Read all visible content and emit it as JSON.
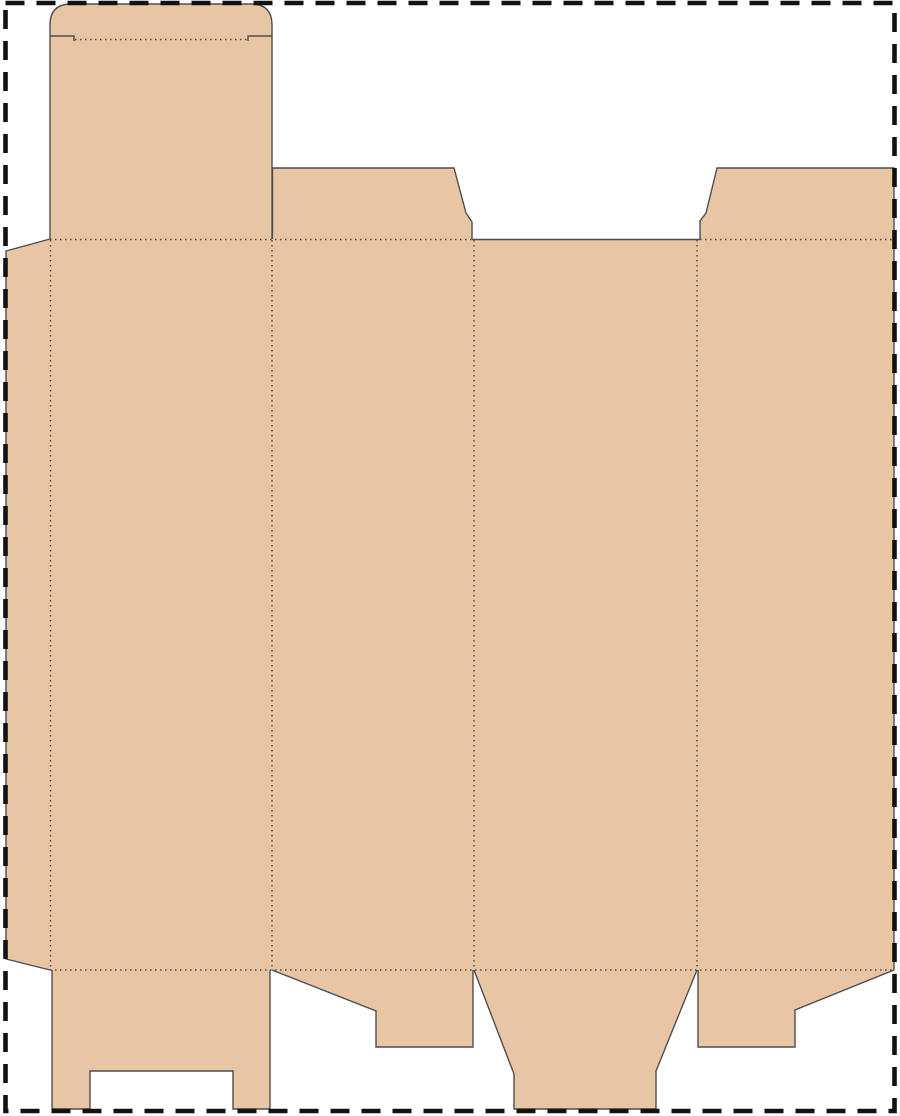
{
  "canvas": {
    "width": 900,
    "height": 1116,
    "background": "#ffffff"
  },
  "colors": {
    "background": "#ffffff",
    "board": "#e9c6a3",
    "cut": "#4f4d53",
    "fold": "#48464e",
    "border": "#121212"
  },
  "line_legend": {
    "solid": "cut edge",
    "dotted": "fold / crease line",
    "dashed": "page boundary"
  },
  "dieline": {
    "description": "Flat tuck-end folding-carton dieline template, clipped by the dashed page border on the right and bottom edges",
    "parts": [
      {
        "id": "glue-flap",
        "role": "left glue flap with angled ends"
      },
      {
        "id": "tuck-flap",
        "role": "rounded tuck flap with shoulder slits"
      },
      {
        "id": "lid-panel",
        "role": "top closure (lid) panel"
      },
      {
        "id": "panel-1",
        "role": "main panel 1"
      },
      {
        "id": "panel-2",
        "role": "main panel 2"
      },
      {
        "id": "panel-3",
        "role": "main panel 3 (plain cut top edge)"
      },
      {
        "id": "panel-4",
        "role": "main panel 4, clipped at page edge"
      },
      {
        "id": "top-dust-flap-left",
        "role": "top dust flap above panel 2"
      },
      {
        "id": "top-dust-flap-right",
        "role": "top dust flap above panel 4, clipped at page edge"
      },
      {
        "id": "bottom-flap-1",
        "role": "bottom flap with rectangular center notch under panel 1"
      },
      {
        "id": "bottom-flap-2",
        "role": "bottom dust flap with angled left edge under panel 2"
      },
      {
        "id": "bottom-flap-3",
        "role": "tapered bottom tuck flap under panel 3, reaching page border"
      },
      {
        "id": "bottom-flap-4",
        "role": "bottom dust flap with angled right edge under panel 4"
      }
    ]
  }
}
